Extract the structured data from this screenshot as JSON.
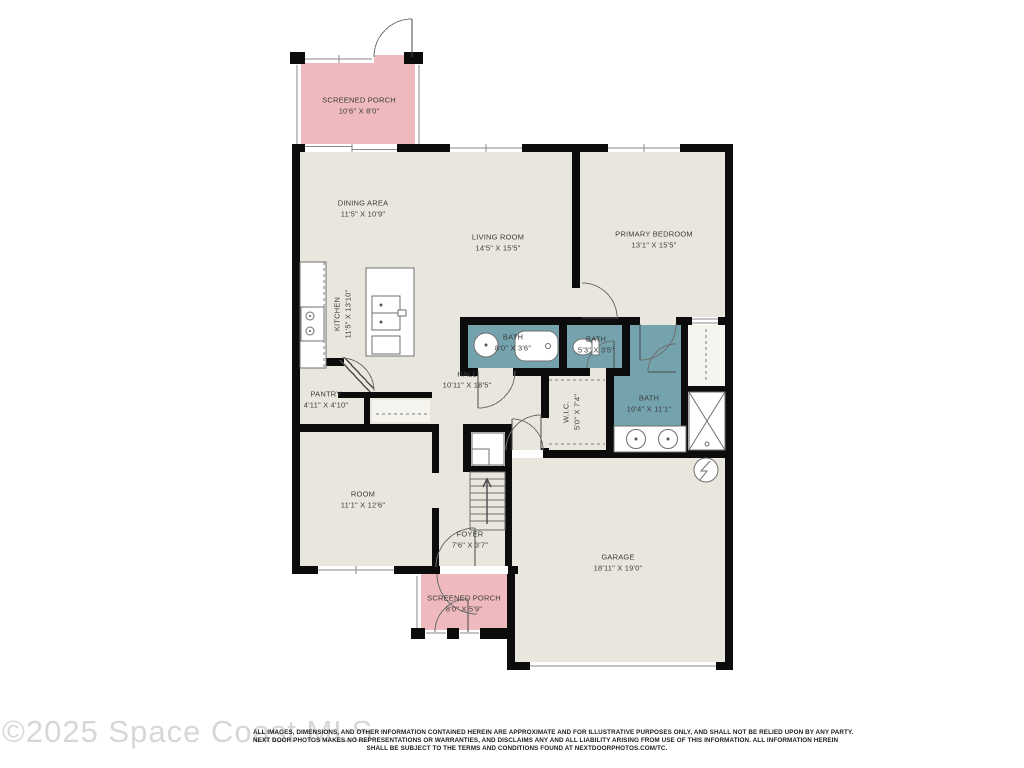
{
  "watermark": {
    "text": "©2025 Space Coast MLS"
  },
  "disclaimer": {
    "line1": "ALL IMAGES, DIMENSIONS, AND OTHER INFORMATION CONTAINED HEREIN ARE APPROXIMATE AND FOR ILLUSTRATIVE PURPOSES ONLY, AND SHALL NOT BE RELIED UPON BY ANY PARTY.",
    "line2": "NEXT DOOR PHOTOS MAKES NO REPRESENTATIONS OR WARRANTIES, AND DISCLAIMS ANY AND ALL LIABILITY ARISING FROM USE OF THIS INFORMATION. ALL INFORMATION HEREIN",
    "line3": "SHALL BE SUBJECT TO THE TERMS AND CONDITIONS FOUND AT NEXTDOORPHOTOS.COM/TC."
  },
  "colors": {
    "floor": "#e9e7dd",
    "porch": "#eebabd",
    "bath": "#74a3ae",
    "wall": "#0c0c0c"
  },
  "rooms": [
    {
      "name": "SCREENED PORCH",
      "dims": "10'6\" X 8'0\""
    },
    {
      "name": "DINING AREA",
      "dims": "11'5\" X 10'9\""
    },
    {
      "name": "LIVING ROOM",
      "dims": "14'5\" X 15'5\""
    },
    {
      "name": "PRIMARY BEDROOM",
      "dims": "13'1\" X 15'5\""
    },
    {
      "name": "KITCHEN",
      "dims": "11'5\" X 13'10\""
    },
    {
      "name": "BATH",
      "dims": "8'0\" X 3'6\""
    },
    {
      "name": "BATH",
      "dims": "5'3\" X 3'5\""
    },
    {
      "name": "HALL",
      "dims": "10'11\" X 18'5\""
    },
    {
      "name": "PANTRY",
      "dims": "4'11\" X 4'10\""
    },
    {
      "name": "W.I.C.",
      "dims": "5'0\" X 7'4\""
    },
    {
      "name": "BATH",
      "dims": "10'4\" X 11'1\""
    },
    {
      "name": "ROOM",
      "dims": "11'1\" X 12'6\""
    },
    {
      "name": "FOYER",
      "dims": "7'6\" X 3'7\""
    },
    {
      "name": "GARAGE",
      "dims": "18'11\" X 19'0\""
    },
    {
      "name": "SCREENED PORCH",
      "dims": "8'0\" X 5'9\""
    }
  ]
}
